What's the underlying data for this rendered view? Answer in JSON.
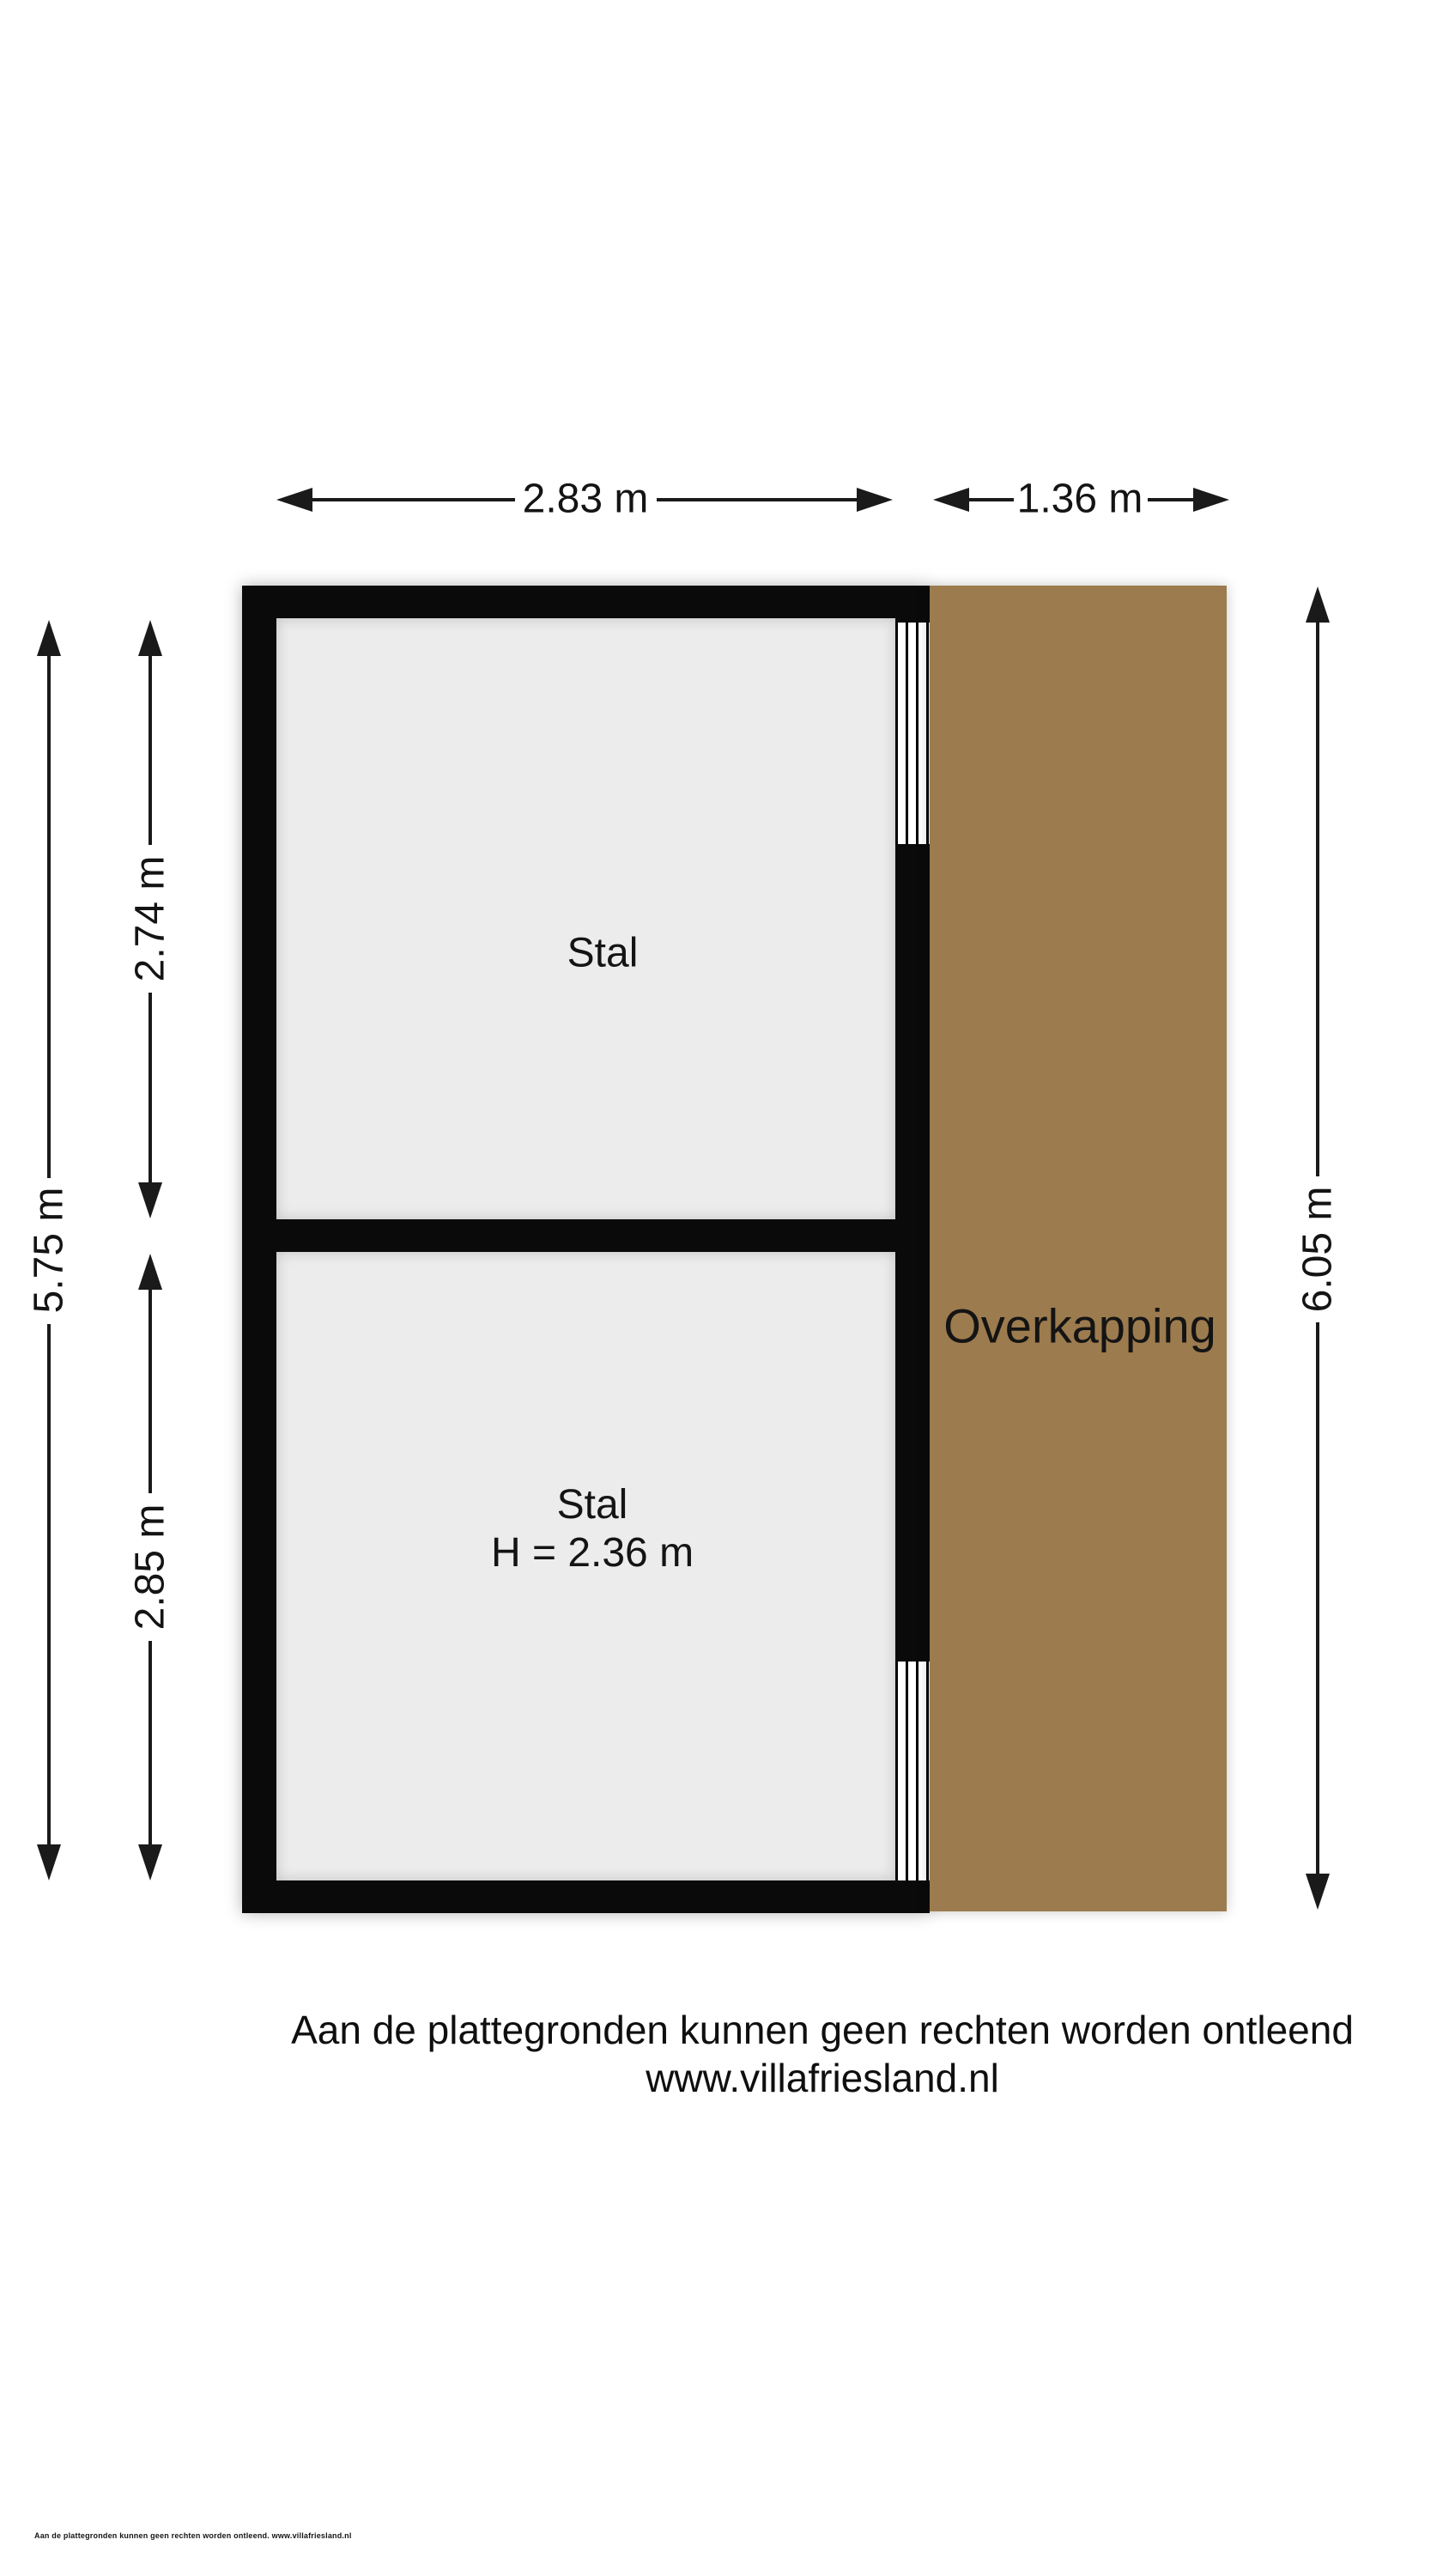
{
  "floorplan": {
    "colors": {
      "wall": "#0a0a0a",
      "room_floor": "#ececec",
      "overkapping": "#9c7b4e"
    },
    "rooms": [
      {
        "label": "Stal"
      },
      {
        "label": "Stal",
        "height_label": "H = 2.36 m"
      }
    ],
    "overkapping_label": "Overkapping",
    "dimensions": {
      "top_width": "2.83 m",
      "top_overkapping_width": "1.36 m",
      "left_total": "5.75 m",
      "left_upper": "2.74 m",
      "left_lower": "2.85 m",
      "right_total": "6.05 m"
    },
    "footer": {
      "disclaimer": "Aan de plattegronden kunnen geen rechten worden ontleend",
      "website": "www.villafriesland.nl",
      "micro_note": "Aan de plattegronden kunnen geen rechten worden ontleend. www.villafriesland.nl"
    }
  }
}
